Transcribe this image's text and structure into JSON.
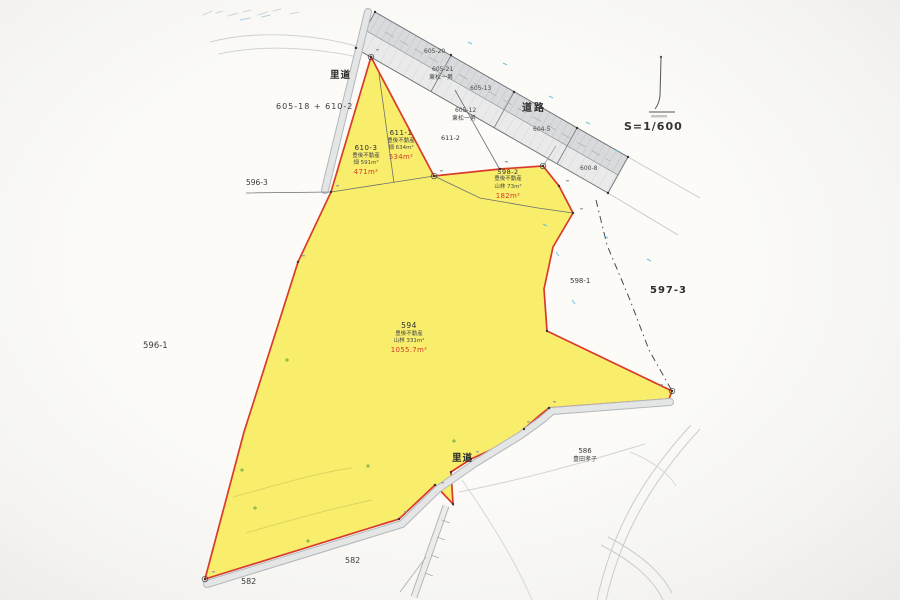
{
  "scale_label": "S=1/600",
  "roads": {
    "main": "道路",
    "satomichi_top": "里道",
    "satomichi_bottom": "里道",
    "parcels": {
      "p605_20": "605-20",
      "p605_21": "605-21",
      "p605_21_owner": "東松一男",
      "p605_13": "605-13",
      "p605_12": "605-12",
      "p605_12_owner": "東松一男",
      "p604_5": "604-5",
      "p600_8": "600-8"
    }
  },
  "parcels": {
    "p594": {
      "id": "594",
      "owner": "豊後不動産",
      "registered": "山林 331m²",
      "measured": "1055.7m²"
    },
    "p610_3": {
      "id": "610-3",
      "owner": "豊後不動産",
      "registered": "畑 591m²",
      "measured": "471m²"
    },
    "p611_1": {
      "id": "611-1",
      "owner": "豊後不動産",
      "registered": "畑 634m²",
      "measured": "534m²"
    },
    "p598_2": {
      "id": "598-2",
      "owner": "豊後不動産",
      "registered": "山林 73m²",
      "measured": "182m²"
    }
  },
  "neighbors": {
    "p605_18_610_2": "605-18 + 610-2",
    "p596_3": "596-3",
    "p596_1": "596-1",
    "p611_2": "611-2",
    "p598_1": "598-1",
    "p597_3": "597-3",
    "p586": "586",
    "p586_owner": "豊田孝子",
    "p582_left": "582",
    "p582_right": "582"
  },
  "colors": {
    "parcel_fill": "#f8ee6b",
    "boundary_red": "#d93a2b",
    "road_fill": "#d9dbdd",
    "measured_text": "#d3392c"
  }
}
